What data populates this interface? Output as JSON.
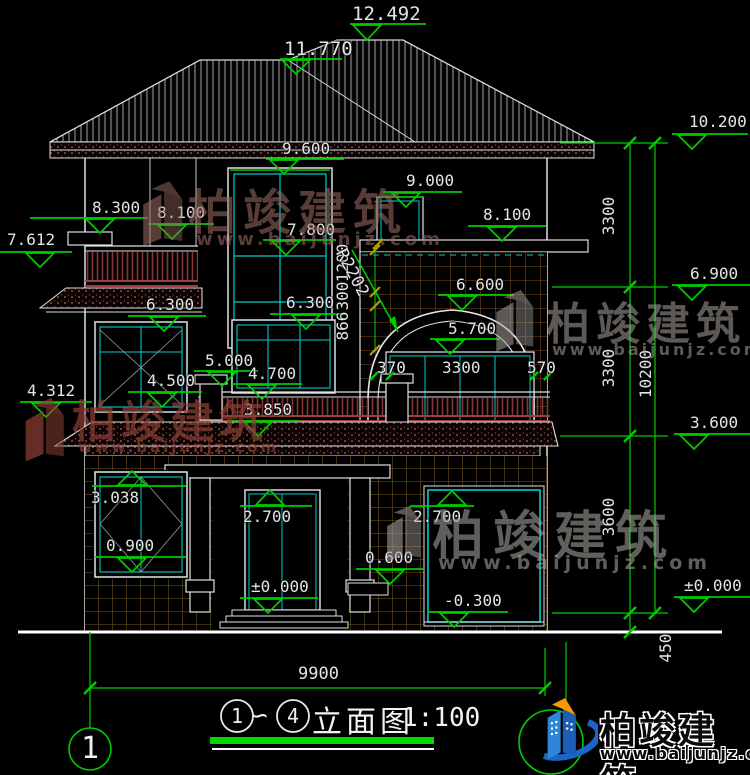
{
  "elevations": {
    "e12492": "12.492",
    "e11770": "11.770",
    "e10200": "10.200",
    "e9600": "9.600",
    "e9000": "9.000",
    "e8300": "8.300",
    "e8100L": "8.100",
    "e8100R": "8.100",
    "e7800": "7.800",
    "e7612": "7.612",
    "e6900": "6.900",
    "e6600": "6.600",
    "e6300L": "6.300",
    "e6300C": "6.300",
    "e5700": "5.700",
    "e5000": "5.000",
    "e4700": "4.700",
    "e4500": "4.500",
    "e4312": "4.312",
    "e3850": "3.850",
    "e3600": "3.600",
    "e3038": "3.038",
    "e2700D": "2.700",
    "e2700G": "2.700",
    "e0900": "0.900",
    "e0600": "0.600",
    "e0000D": "±0.000",
    "e0000R": "±0.000",
    "eM0300": "-0.300"
  },
  "dims": {
    "w370": "370",
    "w3300": "3300",
    "w570": "570",
    "v1200": "1200",
    "v300": "300",
    "v866": "866",
    "r3300a": "3300",
    "r3300b": "3300",
    "r10200": "10200",
    "r3600": "3600",
    "r450": "450",
    "b9900": "9900",
    "radius": "R2202"
  },
  "axis_bubble": {
    "label": "1"
  },
  "drawing_title": {
    "bubble_from": "1",
    "tilde": "∽",
    "bubble_to": "4",
    "name": "立面图",
    "scale": "1:100"
  },
  "watermark": {
    "brand": "柏竣建筑",
    "url": "www.baijunjz.com"
  },
  "logo": {
    "brand": "柏竣建筑",
    "url": "www.baijunjz.com"
  },
  "colors": {
    "marker_green": "#00cc00",
    "window_cyan": "#00cccc",
    "line_white": "#e8e8e8",
    "tile_brown": "#77571f",
    "arch_tile_brown": "#7a4a20",
    "railing_maroon": "#8a3535",
    "title_bar_green": "#00d800",
    "logo_blue": "#1a5fb4",
    "logo_orange": "#f59a00"
  }
}
